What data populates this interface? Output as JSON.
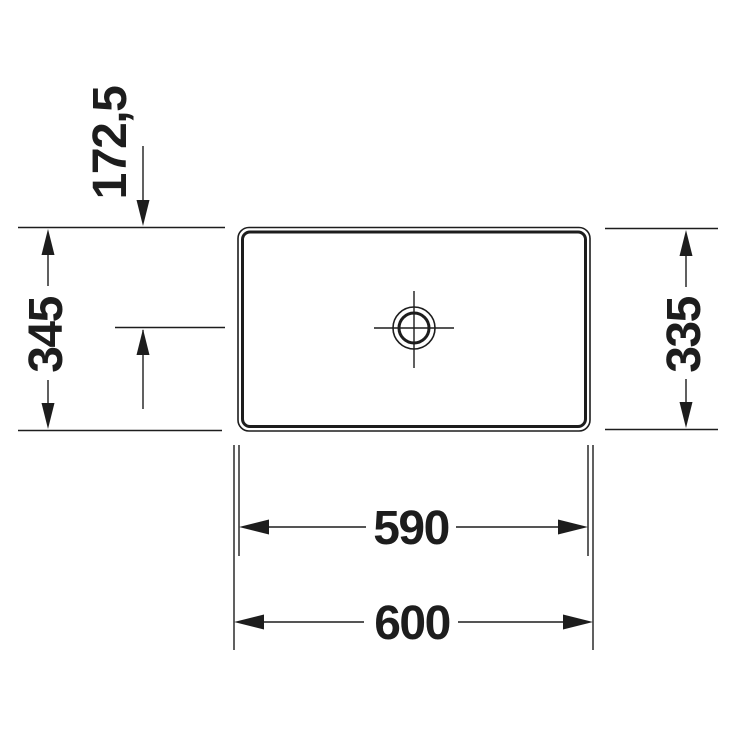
{
  "page": {
    "background_color": "#ffffff",
    "line_color": "#1d1d1d"
  },
  "diagram": {
    "type": "technical-dimension-drawing",
    "subject": "rectangular countertop washbasin with central drain, plan view",
    "units": "mm",
    "labels": {
      "drain_center_offset": "172,5",
      "overall_depth": "345",
      "inner_depth": "335",
      "inner_width": "590",
      "overall_width": "600"
    }
  }
}
